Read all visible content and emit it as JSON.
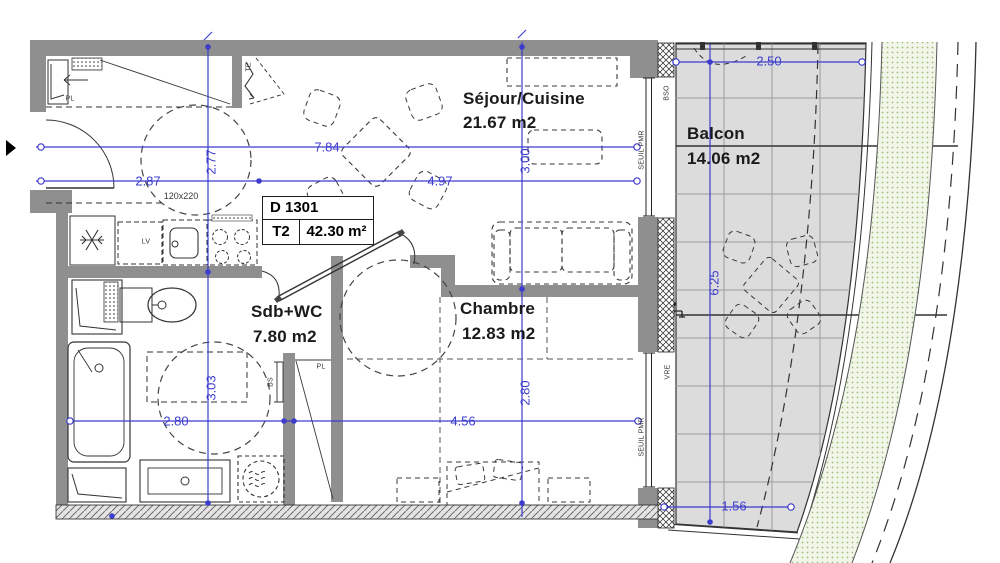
{
  "info_box": {
    "unit": "D 1301",
    "type": "T2",
    "area": "42.30 m²"
  },
  "rooms": {
    "sejour": {
      "name": "Séjour/Cuisine",
      "area": "21.67 m2"
    },
    "balcon": {
      "name": "Balcon",
      "area": "14.06 m2"
    },
    "sdb": {
      "name": "Sdb+WC",
      "area": "7.80 m2"
    },
    "chambre": {
      "name": "Chambre",
      "area": "12.83 m2"
    }
  },
  "dimensions": {
    "sejour_total_width": "7.84",
    "entry_width": "2.87",
    "sejour_width": "4.97",
    "entry_depth": "2.77",
    "sejour_depth": "3.00",
    "sdb_depth": "3.03",
    "sdb_width": "2.80",
    "chambre_width": "4.56",
    "chambre_depth": "2.80",
    "balcon_width": "2.50",
    "balcon_length": "6.25",
    "balcon_end_width": "1.56"
  },
  "annotations": {
    "entry_door_size": "120x220",
    "lv": "LV",
    "te": "TE",
    "pl_entry": "PL",
    "pl_chambre": "PL",
    "bs": "BS",
    "bso": "BSO",
    "seuil_pmr_top": "SEUIL PMR",
    "seuil_pmr_bottom": "SEUIL PMR",
    "vre": "VRE"
  },
  "colors": {
    "dimension_blue": "#3c3ccd",
    "wall_gray": "#8f8f8f",
    "balcony_tile": "#dcdcdc",
    "landscape_green": "#f1f6e9"
  }
}
